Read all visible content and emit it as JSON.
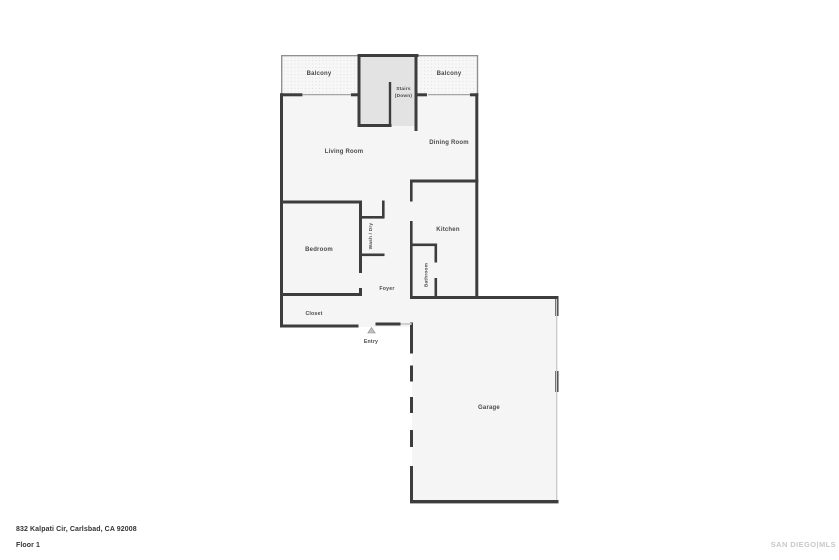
{
  "floorplan": {
    "rooms": {
      "balcony_left": "Balcony",
      "balcony_right": "Balcony",
      "stairs_line1": "Stairs",
      "stairs_line2": "(Down)",
      "living_room": "Living Room",
      "dining_room": "Dining Room",
      "bedroom": "Bedroom",
      "wash_dry": "Wash / Dry",
      "kitchen": "Kitchen",
      "bathroom": "Bathroom",
      "foyer": "Foyer",
      "closet": "Closet",
      "entry": "Entry",
      "garage": "Garage"
    },
    "colors": {
      "wall": "#3d3d3d",
      "interior_fill": "#f5f5f5",
      "stairs_fill": "#e3e3e3",
      "railing": "#909090",
      "label_text": "#4a4a4a",
      "watermark_text": "#c8c8c8"
    }
  },
  "footer": {
    "address": "832 Kalpati Cir, Carlsbad, CA 92008",
    "floor_label": "Floor 1"
  },
  "watermark": {
    "text": "SAN DIEGO|MLS"
  }
}
